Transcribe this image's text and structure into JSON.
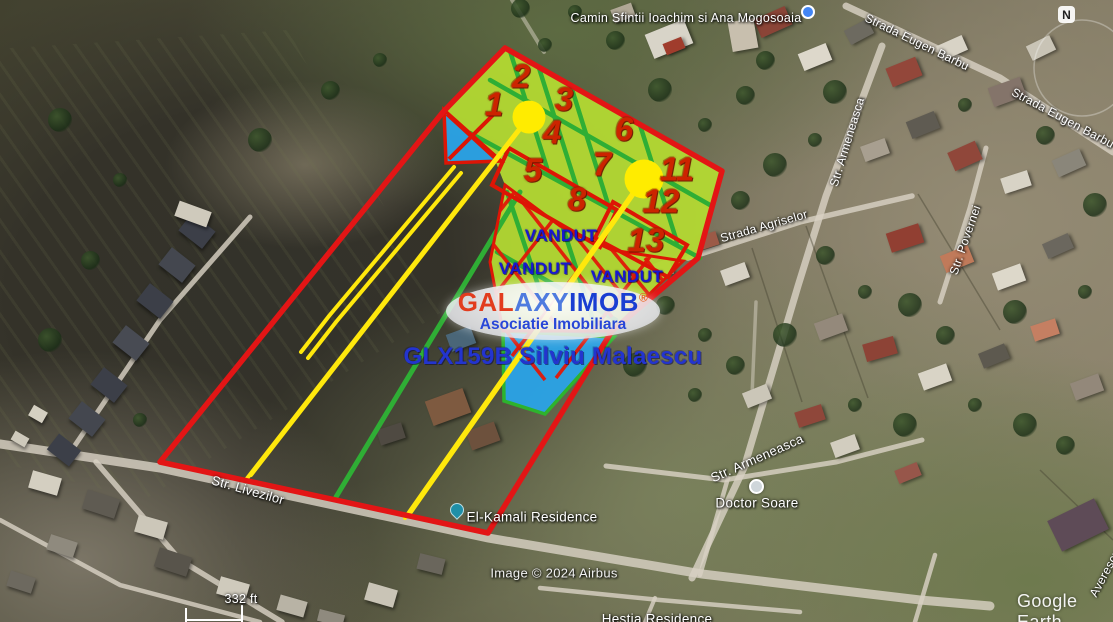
{
  "colors": {
    "boundary_red": "#e31515",
    "plot_green": "#b4da32",
    "line_green": "#2fae35",
    "road_yellow": "#ffe80c",
    "sold_blue": "#2aa3e8",
    "number_red": "#cc2400",
    "vandut_blue": "#1717d2",
    "logo_red": "#e23c1e",
    "logo_blue": "#1a3ed2"
  },
  "plots": {
    "numbers": [
      "1",
      "2",
      "3",
      "4",
      "5",
      "6",
      "7",
      "8",
      "11",
      "12",
      "13"
    ],
    "sold_label": "VANDUT"
  },
  "branding": {
    "logo_gal": "GAL",
    "logo_axy": "AXY",
    "logo_imob": "IMOB",
    "logo_reg": "®",
    "logo_subtitle": "Asociatie Imobiliara",
    "listing_code": "GLX159B Silviu Malaescu"
  },
  "map_labels": {
    "camin": "Camin Sfintii Ioachim si Ana Mogosoaia",
    "eugen_barbu": "Strada Eugen Barbu",
    "eugen_barbu_2": "Strada Eugen Barbu",
    "armeneasca_top": "Str. Armeneasca",
    "agriselor": "Strada Agriselor",
    "povernei": "Str. Povernei",
    "armeneasca_bottom": "Str. Armeneasca",
    "doctor_soare": "Doctor Soare",
    "el_kamali": "El-Kamali Residence",
    "hestia": "Hestia Residence",
    "livezilor": "Str. Livezilor",
    "averescu": "Averescu",
    "compass": "N"
  },
  "attribution": {
    "credit": "Image © 2024 Airbus",
    "scale_label": "332 ft",
    "watermark": "Google Earth"
  }
}
